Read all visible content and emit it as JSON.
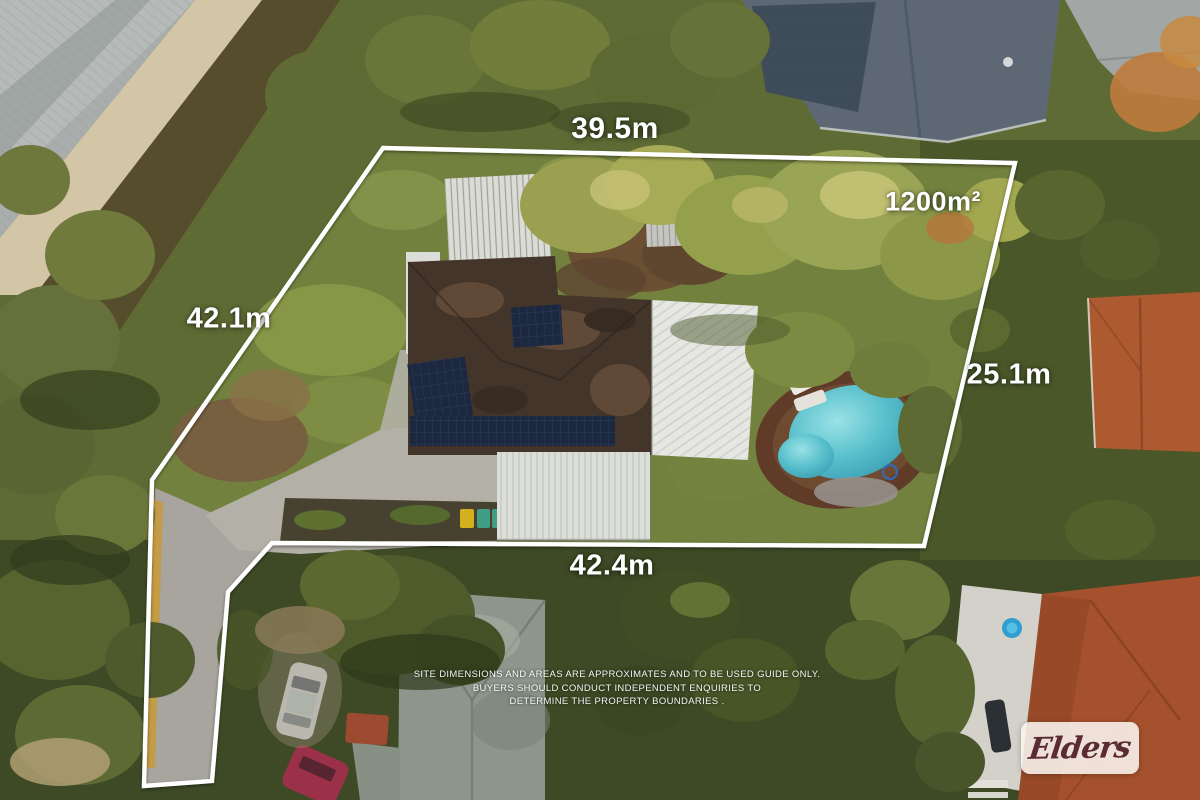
{
  "property_overlay": {
    "dim_top": "39.5m",
    "dim_left": "42.1m",
    "dim_right": "25.1m",
    "dim_bottom": "42.4m",
    "area": "1200m²",
    "disclaimer_line1": "SITE DIMENSIONS AND AREAS ARE APPROXIMATES AND TO BE USED GUIDE ONLY.",
    "disclaimer_line2": "BUYERS SHOULD CONDUCT INDEPENDENT ENQUIRIES TO",
    "disclaimer_line3": "DETERMINE THE PROPERTY BOUNDARIES .",
    "boundary_color": "#ffffff",
    "label_color": "#ffffff"
  },
  "branding": {
    "agency_logo_text": "Elders",
    "logo_text_color": "#5a2b33",
    "logo_background": "#f8f4ee"
  },
  "scene_colors": {
    "pool_water": "#5fc4cf",
    "house_roof_brown": "#44352a",
    "lawn_green": "#72813e",
    "concrete_driveway": "#b2b0a7",
    "terracotta_roof": "#a8512e",
    "big_metal_roof": "#5d6874"
  }
}
